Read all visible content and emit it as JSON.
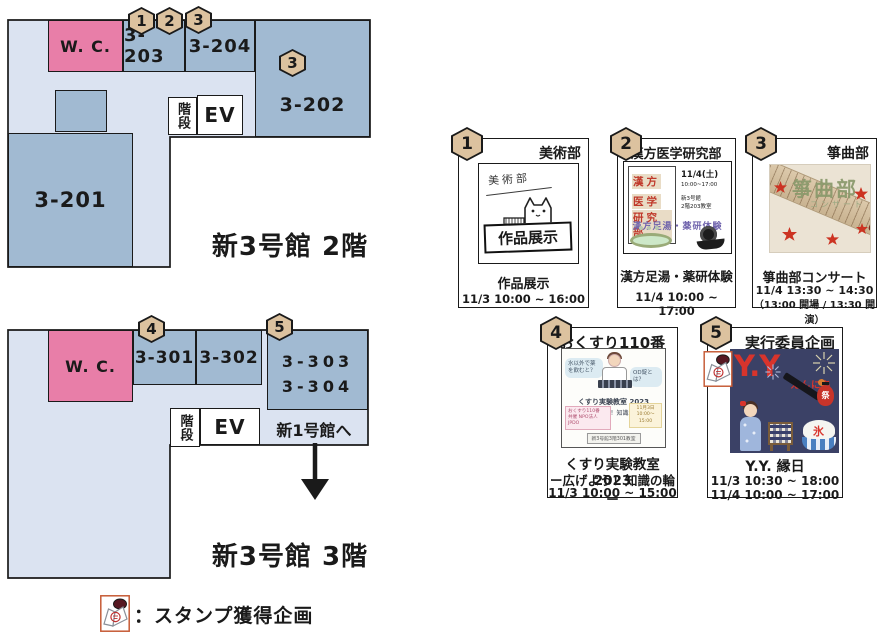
{
  "colors": {
    "corridor": "#dbe3f1",
    "room_blue": "#a1bad2",
    "room_pink": "#e87ea8",
    "badge_tan": "#dcc29f",
    "accent_red": "#d8342c",
    "poster_navy": "#3b4166",
    "stamp_border": "#c65a35"
  },
  "floor2": {
    "title": "新3号館 2階",
    "wc": "W. C.",
    "r203": "3-203",
    "r204": "3-204",
    "r202": "3-202",
    "r201": "3-201",
    "stairs": "階段",
    "ev": "EV",
    "badge203a": "1",
    "badge203b": "2",
    "badge204": "3",
    "badge202": "3"
  },
  "floor3": {
    "title": "新3号館 3階",
    "wc": "W. C.",
    "r301": "3-301",
    "r302": "3-302",
    "r303": "3-303",
    "r304": "3-304",
    "stairs": "階段",
    "ev": "EV",
    "badge301": "4",
    "badge303": "5",
    "exit": "新1号館へ"
  },
  "legend": {
    "label": "：スタンプ獲得企画"
  },
  "cards": [
    {
      "number": "1",
      "club": "美術部",
      "poster": {
        "handwritten": "美術部",
        "sign": "作品展示"
      },
      "caption1": "作品展示",
      "time1": "11/3 10:00 ~ 16:00"
    },
    {
      "number": "2",
      "club": "漢方医学研究部",
      "poster": {
        "line1": "漢方",
        "line2": "医学",
        "line3": "研究部",
        "date": "11/4(土)",
        "time": "10:00~17:00",
        "place1": "新3号館",
        "place2": "2階203教室",
        "band": "漢方足湯・薬研体験"
      },
      "caption1": "漢方足湯・薬研体験",
      "time1": "11/4 10:00 ~ 17:00"
    },
    {
      "number": "3",
      "club": "箏曲部",
      "poster": {
        "main": "箏曲部",
        "sub": "コンサート"
      },
      "caption1": "箏曲部コンサート",
      "time1": "11/4 13:30 ~ 14:30",
      "time2": "（13:00 開場 / 13:30 開演）"
    },
    {
      "number": "4",
      "club": "おくすり110番",
      "poster": {
        "bubble1": "水以外で薬を飲むと？",
        "bubble2": "OD錠とは？",
        "title": "くすり実験教室 2023",
        "sub": "ー広げよう！知識の輪ー",
        "note1": "おくすり110番\n共催 NPO法人JPDO",
        "note2": "11月3日 10:00～15:00",
        "room": "新3号館3階301教室"
      },
      "caption1": "くすり実験教室 2023",
      "caption2": "ー広げよう！知識の輪ー",
      "time1": "11/3 10:00 ~ 15:00"
    },
    {
      "number": "5",
      "club": "実行委員企画",
      "poster": {
        "main": "Y.Y",
        "sub": "えんにち",
        "ice": "氷",
        "lantern": "祭"
      },
      "caption1": "Y.Y. 縁日",
      "time1": "11/3 10:30 ~ 18:00",
      "time2": "11/4 10:00 ~ 17:00"
    }
  ]
}
